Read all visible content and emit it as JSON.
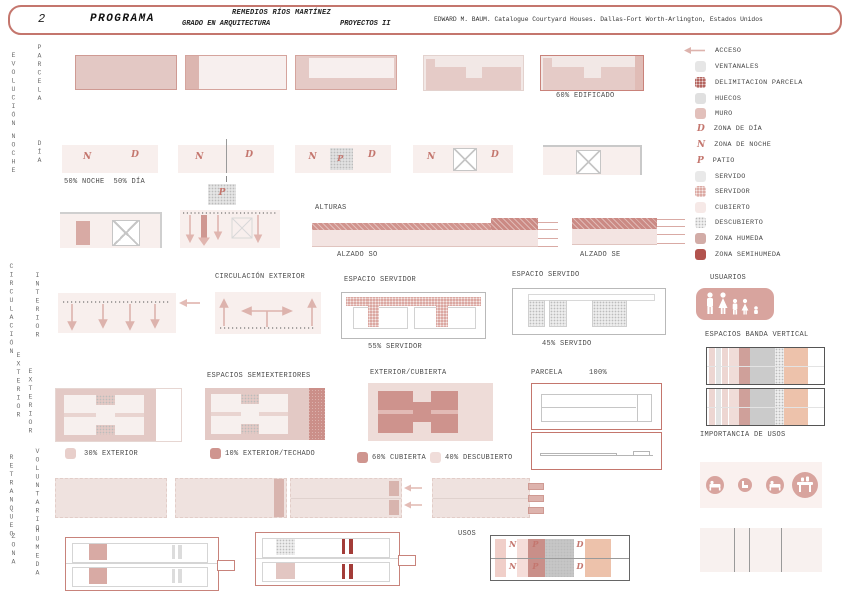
{
  "header": {
    "number": "2",
    "title": "PROGRAMA",
    "author": "REMEDIOS RÍOS MARTÍNEZ",
    "degree": "GRADO EN ARQUITECTURA",
    "course": "PROYECTOS II",
    "reference": "EDWARD M. BAUM. Catalogue Courtyard Houses. Dallas-Fort Worth-Arlington, Estados Unidos"
  },
  "side_labels": {
    "evolucion": "EVOLUCIÓN",
    "parcela": "PARCELA",
    "noche": "NOCHE",
    "dia": "DÍA",
    "circulacion": "CIRCULACIÓN",
    "interior": "INTERIOR",
    "exterior1": "EXTERIOR",
    "exterior2": "EXTERIOR",
    "retranqueo": "RETRANQUEO",
    "voluntario": "VOLUNTARIO",
    "zona": "ZONA",
    "humeda": "HUMEDA"
  },
  "legend": {
    "items": [
      {
        "label": "ACCESO",
        "swatch": "arrow"
      },
      {
        "label": "VENTANALES",
        "swatch": "ventanales"
      },
      {
        "label": "DELIMITACION PARCELA",
        "swatch": "delimitacion-parcela"
      },
      {
        "label": "HUECOS",
        "swatch": "huecos"
      },
      {
        "label": "MURO",
        "swatch": "muro"
      },
      {
        "label": "ZONA DE DÍA",
        "swatch": "letter",
        "letter": "D"
      },
      {
        "label": "ZONA DE NOCHE",
        "swatch": "letter",
        "letter": "N"
      },
      {
        "label": "PATIO",
        "swatch": "letter",
        "letter": "P"
      },
      {
        "label": "SERVIDO",
        "swatch": "servido"
      },
      {
        "label": "SERVIDOR",
        "swatch": "servidor"
      },
      {
        "label": "CUBIERTO",
        "swatch": "cubierto"
      },
      {
        "label": "DESCUBIERTO",
        "swatch": "descubierto"
      },
      {
        "label": "ZONA HUMEDA",
        "swatch": "zona-humeda"
      },
      {
        "label": "ZONA SEMIHUMEDA",
        "swatch": "zona-semihumeda"
      }
    ]
  },
  "letters": {
    "n": "N",
    "d": "D",
    "p": "P"
  },
  "sections": {
    "evolucion": {
      "edificado": "60% EDIFICADO"
    },
    "noche_dia": {
      "caption": "50% NOCHE  50% DÍA"
    },
    "alturas": {
      "title": "ALTURAS",
      "alzado_so": "ALZADO SO",
      "alzado_se": "ALZADO SE"
    },
    "circulacion": {
      "exterior_title": "CIRCULACIÓN EXTERIOR"
    },
    "servidor": {
      "title": "ESPACIO SERVIDOR",
      "caption": "55% SERVIDOR"
    },
    "servido": {
      "title": "ESPACIO SERVIDO",
      "caption": "45% SERVIDO"
    },
    "usuarios": {
      "title": "USUARIOS"
    },
    "bandas": {
      "title": "ESPACIOS BANDA VERTICAL",
      "footer": "IMPORTANCIA DE USOS"
    },
    "exterior": {
      "caption1": "30% EXTERIOR",
      "semi_title": "ESPACIOS SEMIEXTERIORES",
      "caption2": "10% EXTERIOR/TECHADO",
      "cubierta_title": "EXTERIOR/CUBIERTA",
      "caption3": "60% CUBIERTA",
      "caption4": "40% DESCUBIERTO",
      "parcela_title": "PARCELA",
      "parcela_pct": "100%"
    },
    "usos": {
      "title": "USOS"
    }
  },
  "colors": {
    "accent_red": "#c4766d",
    "muro_pink": "#e5cac6",
    "dark_pink": "#ce938d",
    "semihumeda_red": "#a8433e",
    "gray": "#c9c9c9",
    "salmon": "#edc2ab",
    "letter_pink": "#c4766e"
  }
}
